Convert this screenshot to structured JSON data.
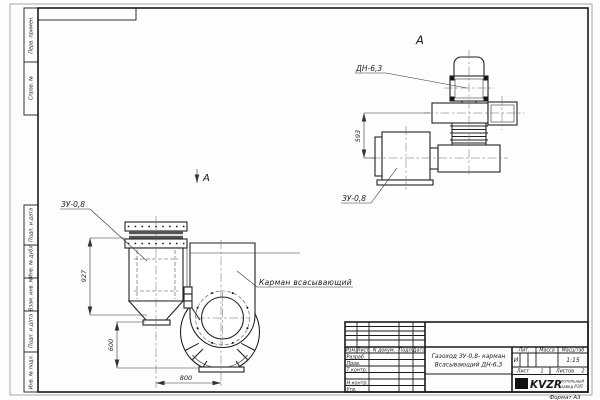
{
  "sheet": {
    "format": "Формат А3"
  },
  "margins": {
    "perv_primen": "Перв. примен.",
    "sprav_no": "Справ. №",
    "podp_data1": "Подп. и дата",
    "inv_dubl": "Инв. № дубл.",
    "vzam_inv": "Взам. инв. №",
    "podp_data2": "Подп. и дата",
    "inv_podl": "Инв. № подл."
  },
  "front_view": {
    "zu_label": "ЗУ-0,8",
    "pocket_label": "Карман всасывающий",
    "view_arrow": "А",
    "dim_height_upper": "927",
    "dim_height_lower": "600",
    "dim_width": "800"
  },
  "top_view": {
    "view_label": "А",
    "dn_label": "ДН-6,3",
    "zu_label": "ЗУ-0,8",
    "dim_height": "593"
  },
  "title_block": {
    "col_izm": "Изм.",
    "col_list": "Лист",
    "col_doc": "N докум.",
    "col_podp": "Подп.",
    "col_data": "Дата",
    "row_razrab": "Разраб.",
    "row_prov": "Пров.",
    "row_tkontr": "Т.контр.",
    "row_nkontr": "Н.контр.",
    "row_utv": "Утв.",
    "title_line1": "Газоход ЗУ-0,8- карман",
    "title_line2": "Всасывающий ДН-6,3",
    "lit_label": "Лит.",
    "lit_value": "И",
    "mass_label": "Масса",
    "scale_label": "Масштаб",
    "scale_value": "1:15",
    "list_label": "Лист",
    "list_value": "1",
    "listov_label": "Листов",
    "listov_value": "2",
    "logo": "KVZR",
    "company_line1": "котельный",
    "company_line2": "завод РЭП"
  }
}
